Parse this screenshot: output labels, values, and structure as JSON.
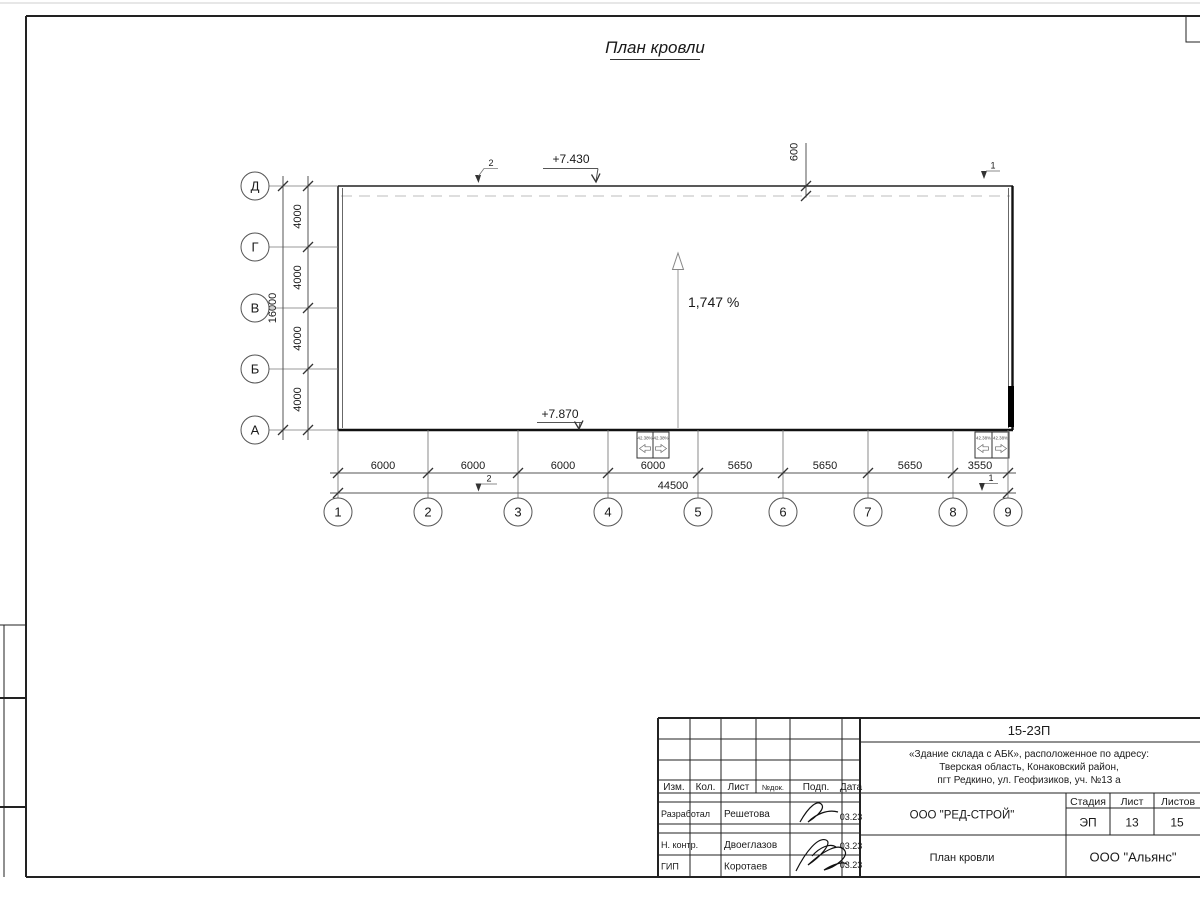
{
  "drawing_title": "План кровли",
  "plan": {
    "vertical_axes": [
      "Д",
      "Г",
      "В",
      "Б",
      "А"
    ],
    "horizontal_axes": [
      "1",
      "2",
      "3",
      "4",
      "5",
      "6",
      "7",
      "8",
      "9"
    ],
    "left_dims": [
      "4000",
      "4000",
      "4000",
      "4000"
    ],
    "left_total": "16000",
    "bottom_dims": [
      "6000",
      "6000",
      "6000",
      "6000",
      "5650",
      "5650",
      "5650",
      "3550"
    ],
    "bottom_total": "44500",
    "elevation_top": "+7.430",
    "elevation_bottom": "+7.870",
    "parapet_offset": "600",
    "slope_label": "1,747 %",
    "drain_slopes": [
      "42.38%",
      "42.38%",
      "42.38%",
      "42.38%"
    ],
    "marker_top_left": "2",
    "marker_top_right": "1",
    "marker_bottom_left": "2",
    "marker_bottom_right": "1"
  },
  "title_block": {
    "code": "15-23П",
    "object_address": [
      "«Здание склада с АБК», расположенное по адресу:",
      "Тверская область, Конаковский район,",
      "пгт Редкино, ул. Геофизиков, уч. №13 а"
    ],
    "headers": {
      "izm": "Изм.",
      "kol": "Кол.",
      "list": "Лист",
      "doc": "№док.",
      "sign": "Подп.",
      "date": "Дата"
    },
    "signature_rows": [
      {
        "role": "Разработал",
        "name": "Решетова",
        "date": "03.23"
      },
      {
        "role": "Н. контр.",
        "name": "Двоеглазов",
        "date": "03.23"
      },
      {
        "role": "ГИП",
        "name": "Коротаев",
        "date": "03.23"
      }
    ],
    "designer_company": "ООО \"РЕД-СТРОЙ\"",
    "stage_header": "Стадия",
    "sheet_header": "Лист",
    "sheets_header": "Листов",
    "stage": "ЭП",
    "sheet": "13",
    "sheets": "15",
    "sheet_name": "План кровли",
    "customer_company": "ООО \"Альянс\""
  }
}
